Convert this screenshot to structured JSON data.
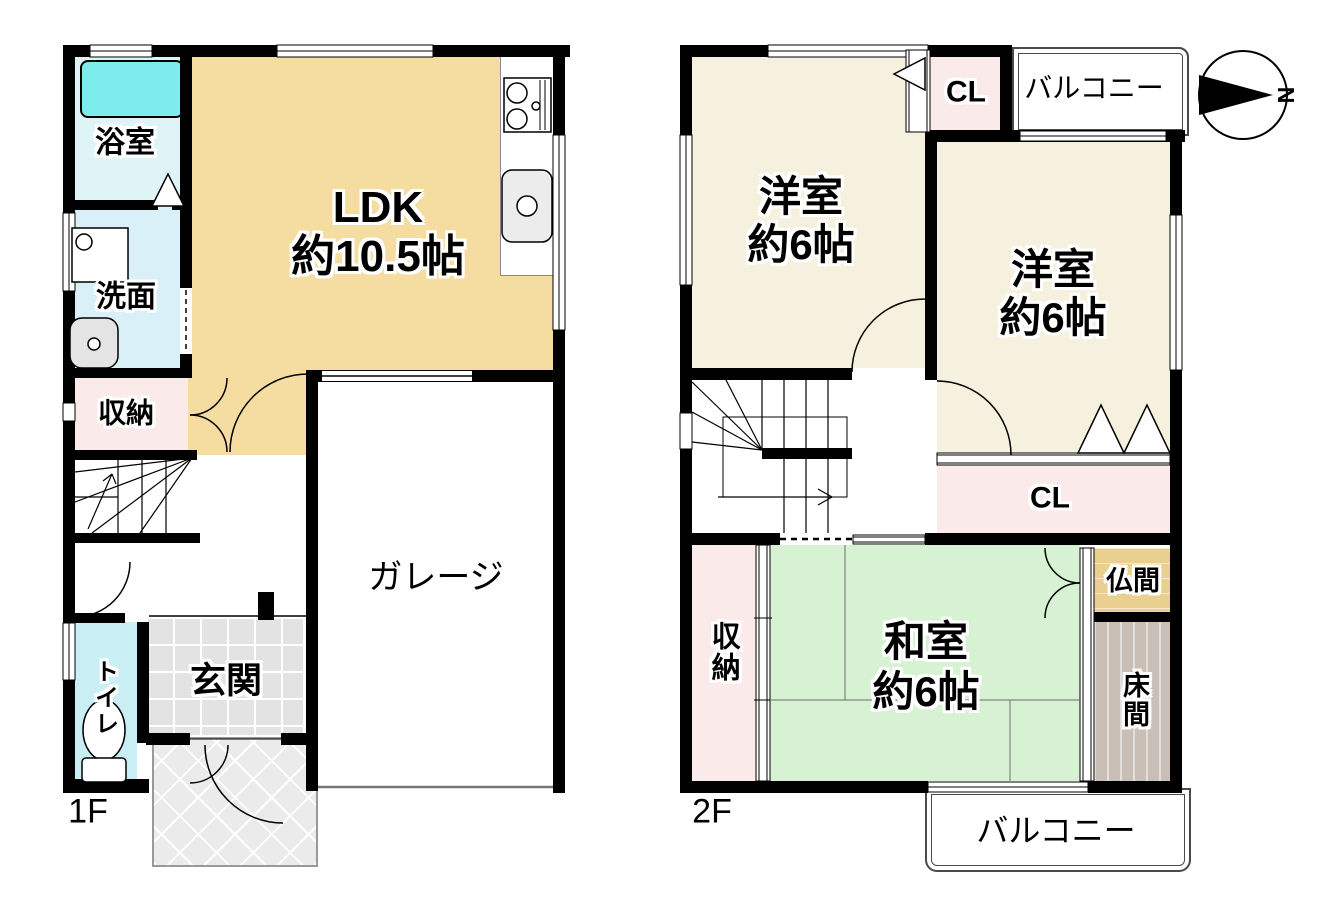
{
  "floor1": {
    "floor_label": "1F",
    "bath": "浴室",
    "washroom": "洗面",
    "storage": "収納",
    "ldk": "LDK",
    "ldk_size": "約10.5帖",
    "garage": "ガレージ",
    "toilet": "トイレ",
    "entrance": "玄関"
  },
  "floor2": {
    "floor_label": "2F",
    "closet_top": "CL",
    "balcony_top": "バルコニー",
    "western1": "洋室",
    "western1_size": "約6帖",
    "western2": "洋室",
    "western2_size": "約6帖",
    "closet_mid": "CL",
    "storage": "収納",
    "japanese": "和室",
    "japanese_size": "約6帖",
    "butsuma": "仏間",
    "tokonoma": "床間",
    "balcony_bottom": "バルコニー"
  },
  "compass": {
    "north": "N"
  },
  "colors": {
    "wall": "#000000",
    "ldk": "#F5DDA1",
    "western_room": "#F6F0DE",
    "japanese_room": "#D7F2D3",
    "closet_pink": "#FBEAEA",
    "bath_floor": "#DFF4F6",
    "bathtub": "#7CECEC",
    "washroom": "#D9F0F8",
    "toilet": "#C9EFF4",
    "entrance_tile": "#E3E3E3",
    "porch": "#EBEBEB",
    "butsuma": "#E9CF90",
    "tokonoma": "#C9BFB6"
  }
}
